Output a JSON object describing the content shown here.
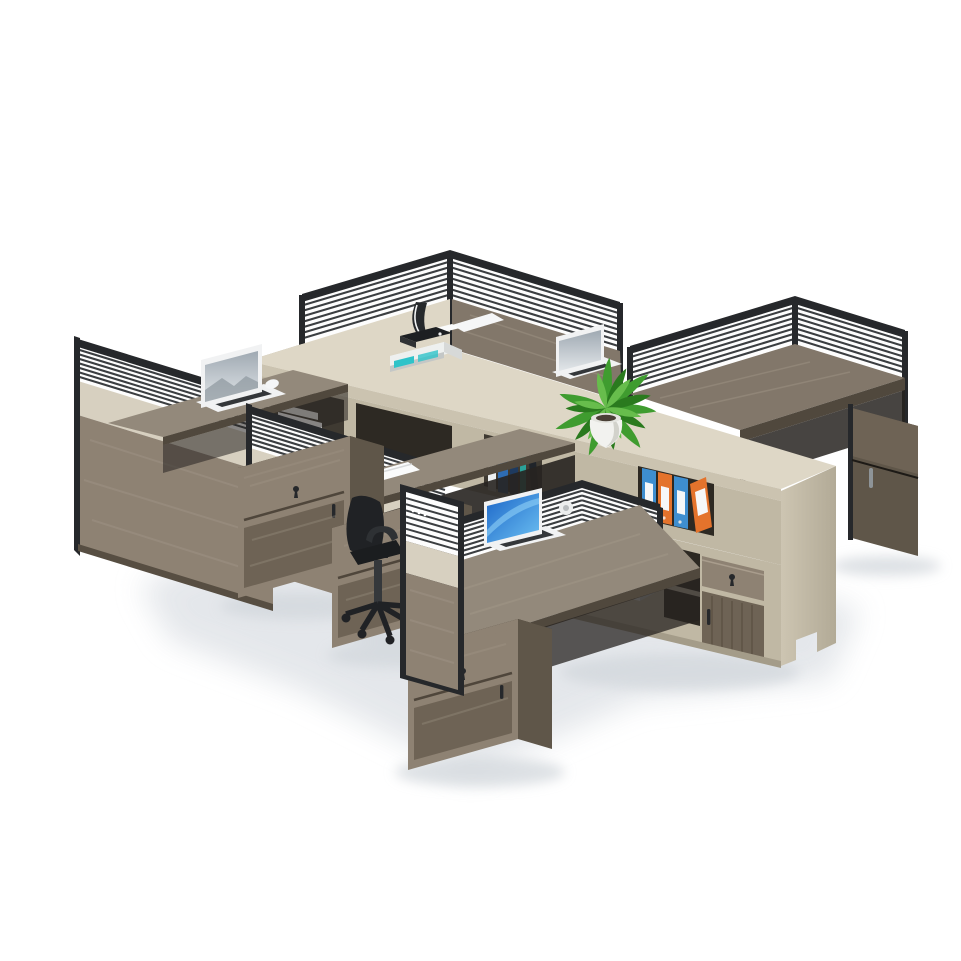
{
  "scene": {
    "type": "product-photo",
    "subject": "modular-office-workstation-cluster",
    "workstation_count": 6,
    "laptop_count": 4,
    "accessories": [
      "printer",
      "potted-plant",
      "ring-binders",
      "books",
      "pen-cup",
      "notepad",
      "mouse-pad",
      "office-chair",
      "mobile-pedestals",
      "storage-cabinet"
    ]
  },
  "colors": {
    "background": "#ffffff",
    "floor_shadow": "#e2e5e9",
    "floor_shadow_dark": "#d2d7dc",
    "spine_top": "#ded7c6",
    "spine_edge": "#cbc3b0",
    "spine_face": "#c0b8a4",
    "spine_west": "#b3ab97",
    "cubby_interior": "#3f3a32",
    "cubby_interior_dark": "#2d2923",
    "wood_surface": "#82776a",
    "wood_surface_light": "#93897b",
    "wood_grain": "#a59a8c",
    "wood_front_edge": "#50483d",
    "wood_panel": "#8e8273",
    "wood_panel_dark": "#6e6355",
    "wood_side": "#5f5649",
    "pedestal_top": "#3e382f",
    "under_shadow": "#272320",
    "frame_black": "#26282b",
    "louver_line": "#3b3e41",
    "panel_white": "#fdfdfd",
    "panel_beige": "#d7d0c0",
    "panel_beige_dark": "#c6bead",
    "laptop_white": "#f1f2f3",
    "screen_gray_top": "#9fa9b2",
    "screen_gray_bottom": "#e2e6e9",
    "screen_blue_top": "#1c66c8",
    "screen_blue_bottom": "#6cc0f2",
    "keyboard_dark": "#34373a",
    "mouse_white": "#f5f6f7",
    "plant_green": "#3f9c2f",
    "plant_green_dark": "#2a7a1e",
    "plant_green_light": "#67bd4c",
    "pot_white": "#f2f2ef",
    "pot_shade": "#c9c9c2",
    "binder_orange": "#e4732c",
    "binder_blue": "#3e8ed0",
    "binder_label": "#f6f7f8",
    "book_white": "#eef0f1",
    "book_blue": "#2e6cb3",
    "book_navy": "#1e3a5f",
    "book_teal": "#2aa198",
    "book_black": "#20242a",
    "chair_dark": "#202225",
    "chair_mid": "#2e3134",
    "metal": "#8e9498",
    "printer_white": "#eef0ef",
    "printer_dark": "#1d1f22",
    "printer_teal": "#2fc3c9",
    "paper_dark": "#26292c",
    "paper_white": "#fafbfb",
    "box_white": "#dadddd",
    "box_top": "#e9ebeb",
    "box_side": "#bfc3c3"
  }
}
